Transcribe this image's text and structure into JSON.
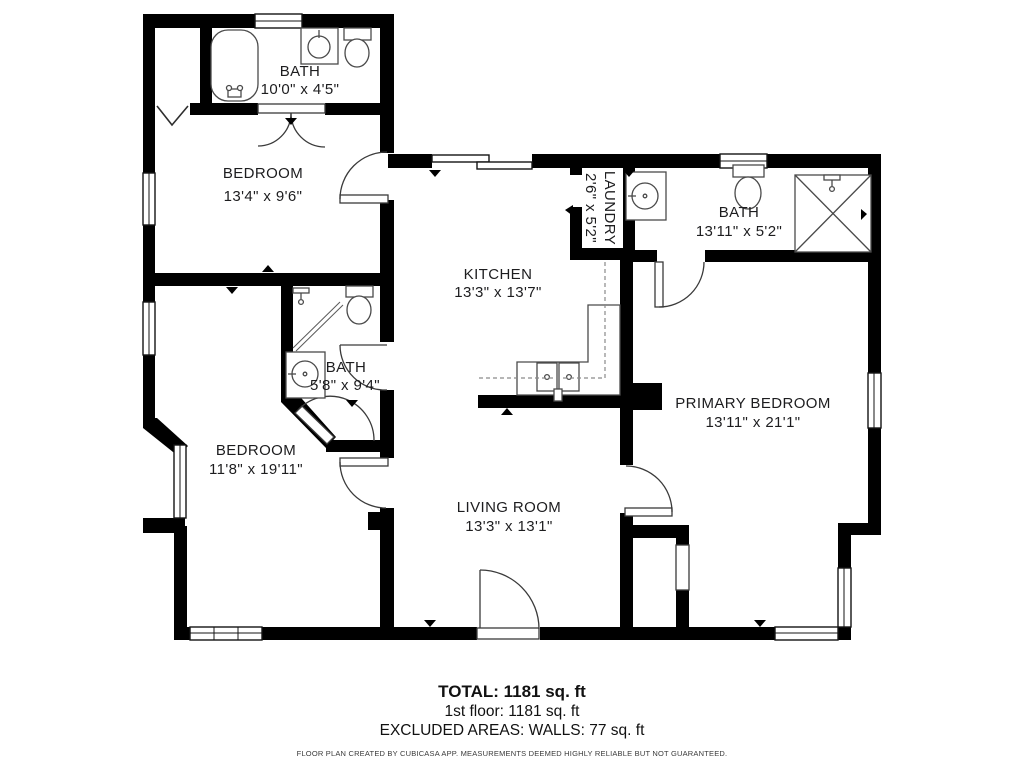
{
  "plan": {
    "rooms": [
      {
        "name": "BATH",
        "dimensions": "10'0\" x 4'5\""
      },
      {
        "name": "BEDROOM",
        "dimensions": "13'4\" x 9'6\""
      },
      {
        "name": "LAUNDRY",
        "dimensions": "2'6\" x 5'2\""
      },
      {
        "name": "BATH",
        "dimensions": "13'11\" x 5'2\""
      },
      {
        "name": "KITCHEN",
        "dimensions": "13'3\" x 13'7\""
      },
      {
        "name": "BATH",
        "dimensions": "5'8\" x 9'4\""
      },
      {
        "name": "BEDROOM",
        "dimensions": "11'8\" x 19'11\""
      },
      {
        "name": "LIVING ROOM",
        "dimensions": "13'3\" x 13'1\""
      },
      {
        "name": "PRIMARY BEDROOM",
        "dimensions": "13'11\" x 21'1\""
      }
    ],
    "fixture_icons": [
      "bathtub-icon",
      "toilet-icon",
      "sink-icon",
      "shower-icon",
      "shower-head-icon",
      "kitchen-sink-icon"
    ]
  },
  "footer": {
    "total": "TOTAL: 1181 sq. ft",
    "floor": "1st floor: 1181 sq. ft",
    "excluded": "EXCLUDED AREAS: WALLS: 77 sq. ft",
    "disclaimer": "FLOOR PLAN CREATED BY CUBICASA APP. MEASUREMENTS DEEMED HIGHLY RELIABLE BUT NOT GUARANTEED."
  },
  "colors": {
    "wall": "#000000",
    "background": "#ffffff",
    "fixture_line": "#4a4a4a",
    "text": "#1d1d1f"
  }
}
